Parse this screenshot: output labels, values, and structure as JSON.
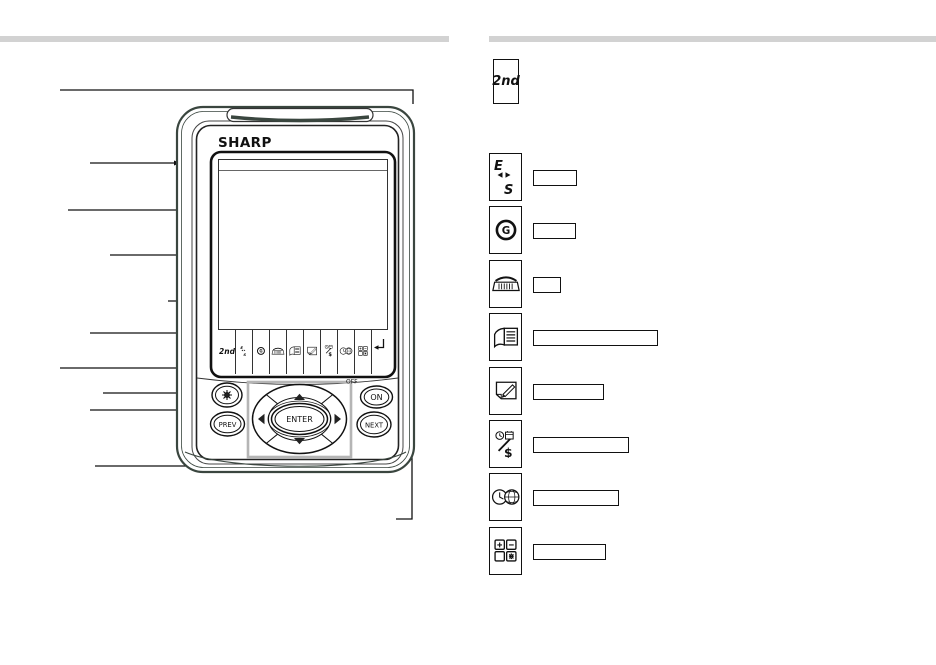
{
  "page": {
    "background": "#ffffff",
    "divider_color": "#d2d2d2",
    "line_color": "#111111",
    "dpad_box_color": "#b5b5b5",
    "body_color": "#3a463f"
  },
  "device": {
    "brand": "SHARP",
    "key_labels": {
      "second": "2nd",
      "e": "E",
      "s": "S",
      "g": "G",
      "enter": "ENTER",
      "prev": "PREV",
      "next": "NEXT",
      "on": "ON",
      "off": "OFF",
      "money_symbol": "$"
    },
    "touch_key_row": [
      "second-function-key",
      "translate-es-key",
      "clock-g-key",
      "phone-key",
      "directory-key",
      "memo-key",
      "schedule-money-key",
      "world-clock-key",
      "calc-key",
      "enter-key"
    ]
  },
  "right_panel": {
    "keys": [
      {
        "name": "second-function-key",
        "icon": "2nd-text",
        "label_box": null
      },
      {
        "name": "translate-es-key",
        "icon": "es",
        "label_box": {
          "width": 44
        }
      },
      {
        "name": "clock-g-key",
        "icon": "clock-g",
        "label_box": {
          "width": 43
        }
      },
      {
        "name": "phone-key",
        "icon": "phone",
        "label_box": {
          "width": 28
        }
      },
      {
        "name": "directory-key",
        "icon": "book",
        "label_box": {
          "width": 125
        }
      },
      {
        "name": "memo-key",
        "icon": "memo",
        "label_box": {
          "width": 71
        }
      },
      {
        "name": "schedule-money-key",
        "icon": "money",
        "label_box": {
          "width": 96
        }
      },
      {
        "name": "world-clock-key",
        "icon": "worldclock",
        "label_box": {
          "width": 86
        }
      },
      {
        "name": "calc-key",
        "icon": "calc",
        "label_box": {
          "width": 73
        }
      }
    ]
  }
}
